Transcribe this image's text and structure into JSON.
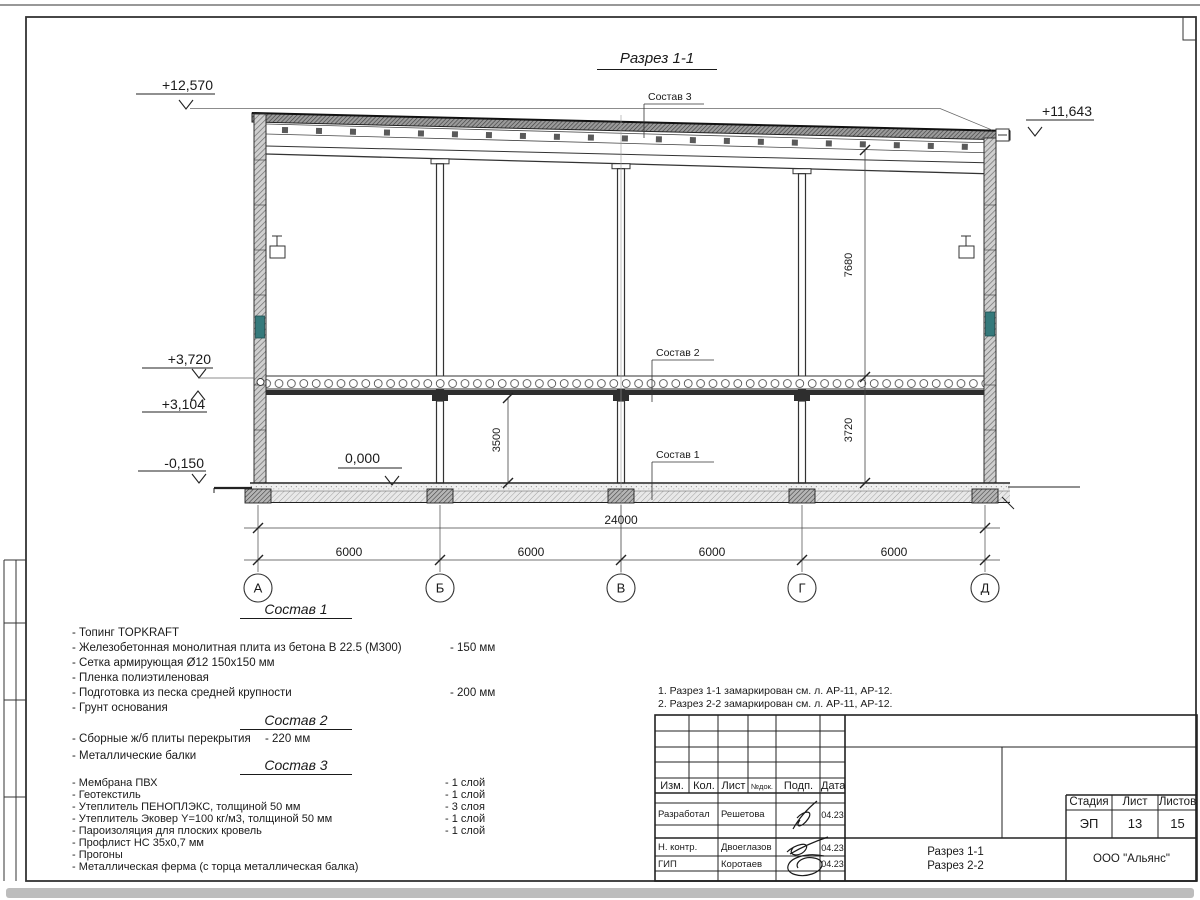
{
  "sheet": {
    "drawing_title": "Разрез 1-1",
    "elevations": {
      "top_left": "+12,570",
      "top_right": "+11,643",
      "level2": "+3,720",
      "beam": "+3,104",
      "ground": "-0,150",
      "zero": "0,000"
    },
    "dims": {
      "total": "24000",
      "bays": [
        "6000",
        "6000",
        "6000",
        "6000"
      ],
      "height_upper": "7680",
      "height_lower": "3720",
      "clear_height": "3500"
    },
    "axes": [
      "А",
      "Б",
      "В",
      "Г",
      "Д"
    ],
    "layer_labels": {
      "s1": "Состав 1",
      "s2": "Состав 2",
      "s3": "Состав 3"
    }
  },
  "compositions": [
    {
      "heading": "Состав 1",
      "items": [
        {
          "text": "- Топинг TOPKRAFT",
          "value": ""
        },
        {
          "text": "- Железобетонная  монолитная плита из бетона  В 22.5 (М300)",
          "value": "- 150 мм"
        },
        {
          "text": "- Сетка армирующая Ø12 150х150 мм",
          "value": ""
        },
        {
          "text": "- Пленка полиэтиленовая",
          "value": ""
        },
        {
          "text": "- Подготовка из песка средней  крупности",
          "value": "- 200 мм"
        },
        {
          "text": "- Грунт основания",
          "value": ""
        }
      ]
    },
    {
      "heading": "Состав 2",
      "items": [
        {
          "text": "- Сборные ж/б плиты перекрытия",
          "value": "- 220 мм"
        },
        {
          "text": "- Металлические балки",
          "value": ""
        }
      ]
    },
    {
      "heading": "Состав 3",
      "items": [
        {
          "text": "- Мембрана ПВХ",
          "value": "- 1 слой"
        },
        {
          "text": "- Геотекстиль",
          "value": "- 1 слой"
        },
        {
          "text": "- Утеплитель ПЕНОПЛЭКС, толщиной 50 мм",
          "value": "- 3 слоя"
        },
        {
          "text": "- Утеплитель Эковер Y=100 кг/м3, толщиной 50 мм",
          "value": "- 1 слой"
        },
        {
          "text": "- Пароизоляция для плоских кровель",
          "value": "- 1 слой"
        },
        {
          "text": "- Профлист НС 35х0,7 мм",
          "value": ""
        },
        {
          "text": "- Прогоны",
          "value": ""
        },
        {
          "text": "- Металлическая ферма (с торца металлическая балка)",
          "value": ""
        }
      ]
    }
  ],
  "notes": [
    "1. Разрез 1-1 замаркирован см. л. АР-11, АР-12.",
    "2. Разрез 2-2 замаркирован см. л. АР-11, АР-12."
  ],
  "titleblock": {
    "columns": [
      "Изм.",
      "Кол.",
      "Лист",
      "№док.",
      "Подп.",
      "Дата"
    ],
    "rows": [
      {
        "role": "Разработал",
        "name": "Решетова",
        "date": "04.23"
      },
      {
        "role": "Н. контр.",
        "name": "Двоеглазов",
        "date": "04.23"
      },
      {
        "role": "ГИП",
        "name": "Коротаев",
        "date": "04.23"
      }
    ],
    "stage_label": "Стадия",
    "stage": "ЭП",
    "sheet_label": "Лист",
    "sheet": "13",
    "total_label": "Листов",
    "total": "15",
    "title_line1": "Разрез 1-1",
    "title_line2": "Разрез 2-2",
    "company": "ООО \"Альянс\""
  }
}
